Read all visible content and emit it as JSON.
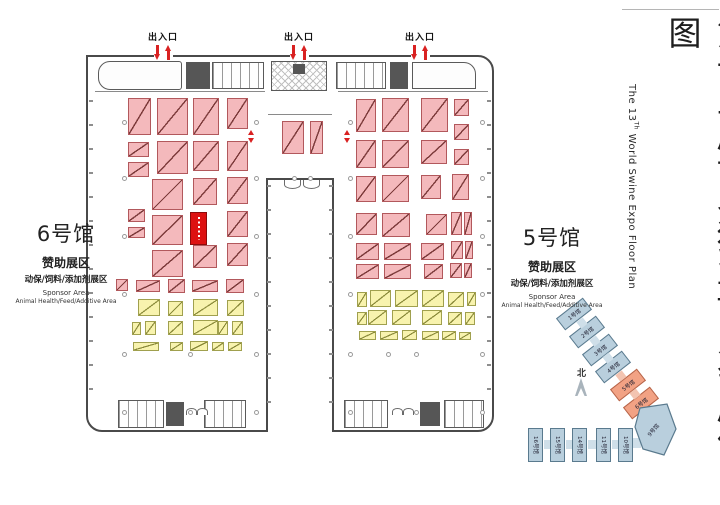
{
  "title": {
    "cn": "第十三届世界猪业博览会展位图",
    "en_prefix": "The 13",
    "en_sup": "Th",
    "en_rest": " World Swine Expo Floor Plan"
  },
  "entrances": {
    "label": "出入口",
    "positions": [
      163,
      299,
      420
    ]
  },
  "halls": {
    "hall6": {
      "name": "6号馆",
      "zone": "赞助展区",
      "zone_detail": "动保/饲料/添加剂展区",
      "sponsor_en": "Sponsor Area",
      "sponsor_detail_en": "Animal Health/Feed/Additive Area"
    },
    "hall5": {
      "name": "5号馆",
      "zone": "赞助展区",
      "zone_detail": "动保/饲料/添加剂展区",
      "sponsor_en": "Sponsor Area",
      "sponsor_detail_en": "Animal Health/Feed/Additive Area"
    }
  },
  "compass": {
    "label": "北"
  },
  "minimap": {
    "diagonal_halls": [
      {
        "label": "1号馆",
        "color": "blue",
        "cx": 574,
        "cy": 314
      },
      {
        "label": "2号馆",
        "color": "blue",
        "cx": 587,
        "cy": 332
      },
      {
        "label": "3号馆",
        "color": "blue",
        "cx": 600,
        "cy": 350
      },
      {
        "label": "4号馆",
        "color": "blue",
        "cx": 613,
        "cy": 367
      },
      {
        "label": "5号馆",
        "color": "orange",
        "cx": 628,
        "cy": 385
      },
      {
        "label": "6号馆",
        "color": "orange",
        "cx": 641,
        "cy": 403
      }
    ],
    "polygon_hall": {
      "label": "9号馆"
    },
    "bottom_halls": [
      {
        "label": "16号馆",
        "x": 528
      },
      {
        "label": "15号馆",
        "x": 550
      },
      {
        "label": "14号馆",
        "x": 572
      },
      {
        "label": "11号馆",
        "x": 596
      },
      {
        "label": "10号馆",
        "x": 618
      }
    ],
    "connectors": [
      [
        578,
        319,
        8,
        8,
        -38,
        "blue_light"
      ],
      [
        591,
        337,
        8,
        8,
        -38,
        "blue_light"
      ],
      [
        604,
        354,
        8,
        8,
        -38,
        "blue_light"
      ],
      [
        617,
        372,
        8,
        8,
        -38,
        "orange_light"
      ],
      [
        631,
        390,
        8,
        8,
        -38,
        "orange_light"
      ],
      [
        645,
        408,
        8,
        8,
        -38,
        "orange_light"
      ],
      [
        544,
        440,
        7,
        9,
        0,
        "blue_light"
      ],
      [
        566,
        440,
        7,
        9,
        0,
        "blue_light"
      ],
      [
        588,
        440,
        9,
        9,
        0,
        "blue_light"
      ],
      [
        612,
        440,
        7,
        9,
        0,
        "blue_light"
      ],
      [
        632,
        438,
        9,
        10,
        0,
        "blue_light"
      ]
    ],
    "colors": {
      "blue": "#b9cfdd",
      "blue_b": "#5a7a8e",
      "blue_light": "#cfdfe9",
      "orange": "#f2a284",
      "orange_b": "#b5654a",
      "orange_light": "#f3c4b1"
    }
  },
  "booths": {
    "colors": {
      "pink": "#f4b9bc",
      "pink_b": "#b2585c",
      "yellow": "#f8f3ae",
      "yellow_b": "#a0a04e",
      "red": "#dd1111",
      "arrow_red": "#d92121"
    },
    "pink": [
      [
        128,
        98,
        23,
        37
      ],
      [
        157,
        98,
        31,
        37
      ],
      [
        193,
        98,
        26,
        37
      ],
      [
        227,
        98,
        21,
        31
      ],
      [
        128,
        142,
        21,
        15
      ],
      [
        157,
        141,
        31,
        33
      ],
      [
        193,
        141,
        26,
        30
      ],
      [
        227,
        141,
        21,
        30
      ],
      [
        128,
        162,
        21,
        15
      ],
      [
        152,
        179,
        31,
        31
      ],
      [
        193,
        178,
        24,
        27
      ],
      [
        227,
        177,
        21,
        27
      ],
      [
        128,
        209,
        17,
        13
      ],
      [
        152,
        215,
        31,
        30
      ],
      [
        227,
        211,
        21,
        26
      ],
      [
        128,
        227,
        17,
        11
      ],
      [
        152,
        250,
        31,
        27
      ],
      [
        193,
        245,
        24,
        23
      ],
      [
        227,
        243,
        21,
        23
      ],
      [
        116,
        279,
        12,
        12
      ],
      [
        136,
        280,
        24,
        12
      ],
      [
        168,
        279,
        17,
        14
      ],
      [
        192,
        280,
        26,
        12
      ],
      [
        226,
        279,
        18,
        14
      ],
      [
        282,
        121,
        22,
        33
      ],
      [
        310,
        121,
        13,
        33
      ],
      [
        356,
        99,
        20,
        33
      ],
      [
        382,
        98,
        27,
        34
      ],
      [
        421,
        98,
        27,
        34
      ],
      [
        454,
        99,
        15,
        17
      ],
      [
        454,
        124,
        15,
        16
      ],
      [
        356,
        140,
        20,
        28
      ],
      [
        382,
        140,
        27,
        28
      ],
      [
        421,
        140,
        26,
        24
      ],
      [
        454,
        149,
        15,
        16
      ],
      [
        356,
        176,
        20,
        26
      ],
      [
        382,
        175,
        27,
        27
      ],
      [
        421,
        175,
        20,
        24
      ],
      [
        452,
        174,
        17,
        26
      ],
      [
        356,
        213,
        21,
        22
      ],
      [
        382,
        213,
        28,
        24
      ],
      [
        426,
        214,
        21,
        21
      ],
      [
        451,
        212,
        11,
        23
      ],
      [
        464,
        212,
        8,
        23
      ],
      [
        356,
        243,
        23,
        17
      ],
      [
        384,
        243,
        27,
        17
      ],
      [
        421,
        243,
        23,
        17
      ],
      [
        451,
        241,
        12,
        18
      ],
      [
        465,
        241,
        8,
        18
      ],
      [
        356,
        264,
        23,
        15
      ],
      [
        384,
        264,
        27,
        15
      ],
      [
        424,
        264,
        19,
        15
      ],
      [
        450,
        263,
        12,
        15
      ],
      [
        464,
        263,
        8,
        15
      ]
    ],
    "yellow": [
      [
        138,
        299,
        22,
        17
      ],
      [
        168,
        301,
        15,
        15
      ],
      [
        193,
        299,
        25,
        17
      ],
      [
        227,
        300,
        17,
        16
      ],
      [
        132,
        322,
        9,
        13
      ],
      [
        145,
        321,
        11,
        14
      ],
      [
        168,
        321,
        15,
        14
      ],
      [
        193,
        320,
        25,
        15
      ],
      [
        218,
        321,
        10,
        14
      ],
      [
        232,
        321,
        11,
        14
      ],
      [
        133,
        342,
        26,
        9
      ],
      [
        170,
        342,
        13,
        9
      ],
      [
        190,
        341,
        18,
        10
      ],
      [
        212,
        342,
        12,
        9
      ],
      [
        228,
        342,
        14,
        9
      ],
      [
        357,
        292,
        10,
        15
      ],
      [
        370,
        290,
        21,
        17
      ],
      [
        395,
        290,
        23,
        17
      ],
      [
        422,
        290,
        22,
        17
      ],
      [
        448,
        292,
        16,
        15
      ],
      [
        467,
        292,
        9,
        14
      ],
      [
        357,
        312,
        10,
        13
      ],
      [
        368,
        310,
        19,
        15
      ],
      [
        392,
        310,
        19,
        15
      ],
      [
        422,
        310,
        20,
        15
      ],
      [
        448,
        312,
        14,
        13
      ],
      [
        465,
        312,
        10,
        13
      ],
      [
        359,
        331,
        17,
        9
      ],
      [
        380,
        331,
        18,
        9
      ],
      [
        402,
        330,
        15,
        10
      ],
      [
        422,
        331,
        17,
        9
      ],
      [
        442,
        331,
        14,
        9
      ],
      [
        459,
        332,
        12,
        8
      ]
    ],
    "red": [
      [
        190,
        212,
        17,
        33
      ]
    ]
  },
  "columns": [
    [
      122,
      120
    ],
    [
      122,
      176
    ],
    [
      122,
      234
    ],
    [
      122,
      292
    ],
    [
      122,
      352
    ],
    [
      122,
      410
    ],
    [
      254,
      120
    ],
    [
      254,
      176
    ],
    [
      254,
      234
    ],
    [
      254,
      292
    ],
    [
      254,
      352
    ],
    [
      254,
      410
    ],
    [
      188,
      352
    ],
    [
      188,
      410
    ],
    [
      292,
      176
    ],
    [
      308,
      176
    ],
    [
      348,
      120
    ],
    [
      348,
      176
    ],
    [
      348,
      234
    ],
    [
      348,
      292
    ],
    [
      348,
      352
    ],
    [
      348,
      410
    ],
    [
      480,
      120
    ],
    [
      480,
      176
    ],
    [
      480,
      234
    ],
    [
      480,
      292
    ],
    [
      480,
      352
    ],
    [
      480,
      410
    ],
    [
      414,
      352
    ],
    [
      414,
      410
    ],
    [
      386,
      352
    ]
  ],
  "red_markers": [
    [
      248,
      130
    ],
    [
      344,
      130
    ]
  ]
}
